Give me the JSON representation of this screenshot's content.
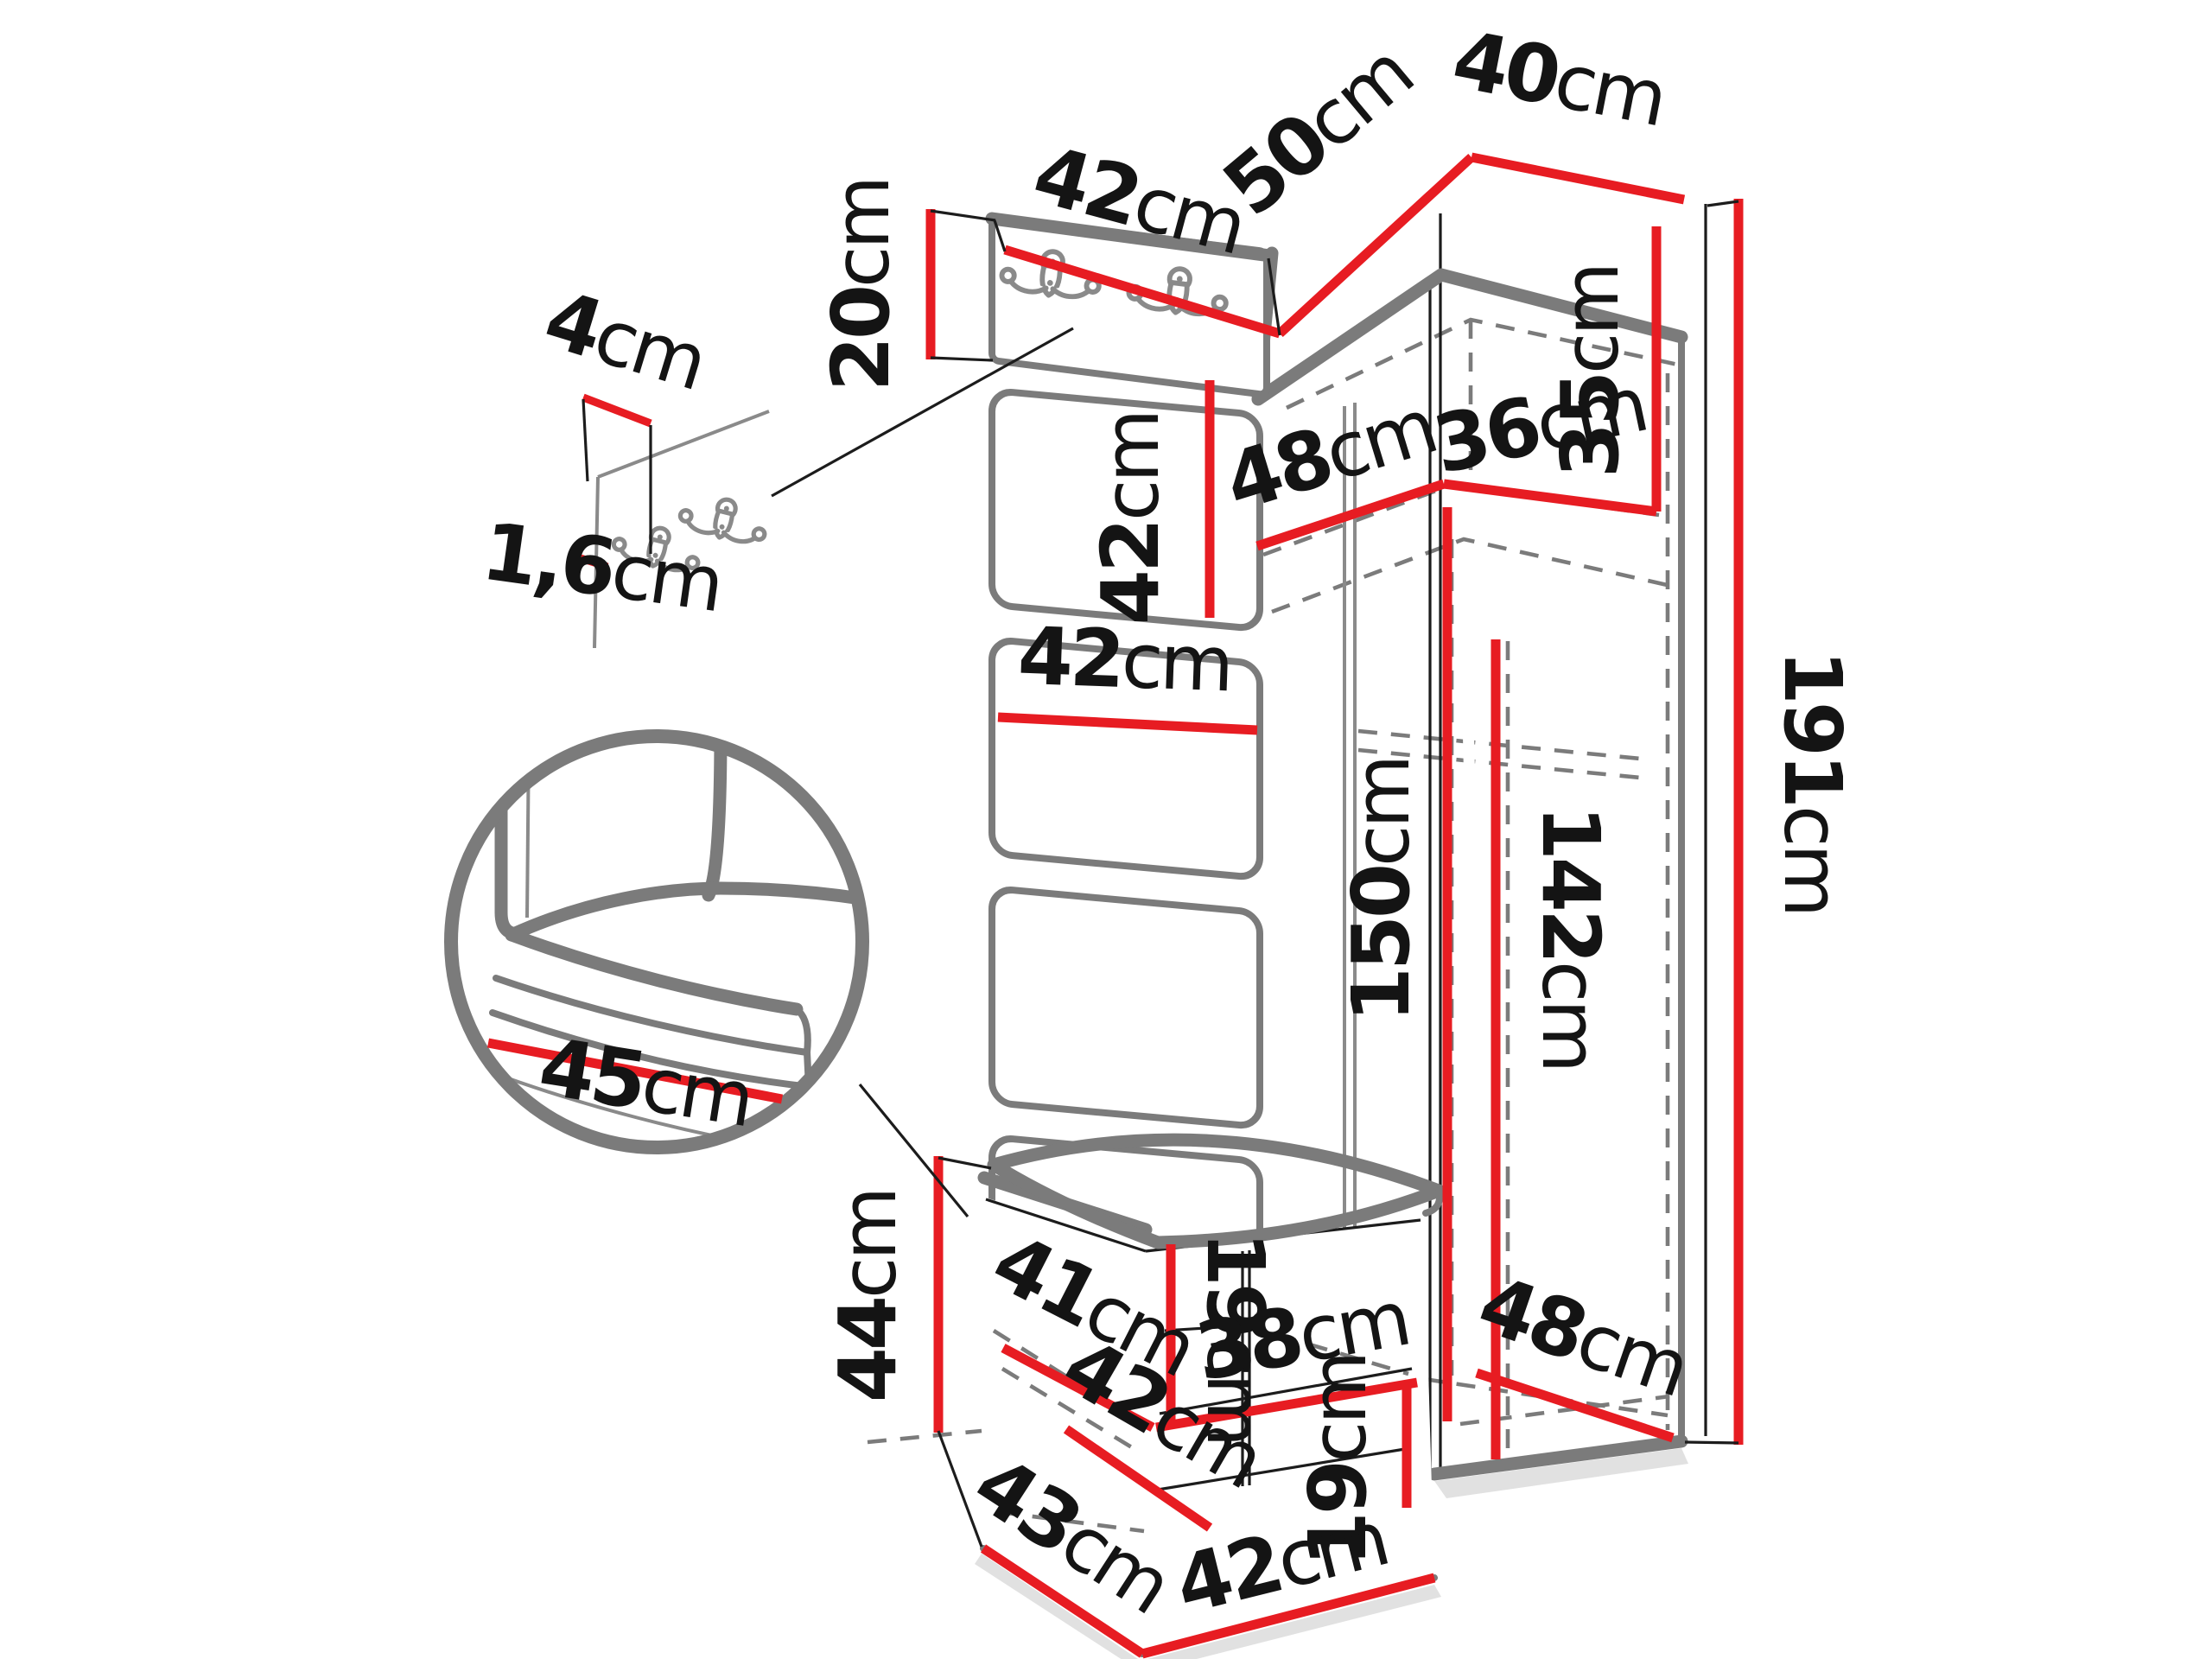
{
  "colors": {
    "dimension_red": "#e71c22",
    "outline_gray": "#7b7b7b",
    "label_black": "#141414",
    "background": "#ffffff"
  },
  "dims": {
    "top_panel_width": {
      "v": "42",
      "u": "cm"
    },
    "top_left_depth": {
      "v": "50",
      "u": "cm"
    },
    "top_right_width": {
      "v": "40",
      "u": "cm"
    },
    "hook_panel_height": {
      "v": "20",
      "u": "cm"
    },
    "upper_panel_height": {
      "v": "42",
      "u": "cm"
    },
    "top_shelf_depth": {
      "v": "48",
      "u": "cm"
    },
    "top_shelf_width": {
      "v": "36",
      "u": "cm"
    },
    "top_compartment_height": {
      "v": "35",
      "u": "cm"
    },
    "panel_width": {
      "v": "42",
      "u": "cm"
    },
    "interior_height_left": {
      "v": "150",
      "u": "cm"
    },
    "interior_height_right": {
      "v": "142",
      "u": "cm"
    },
    "total_height": {
      "v": "191",
      "u": "cm"
    },
    "bench_height": {
      "v": "44",
      "u": "cm"
    },
    "bench_inner_depth": {
      "v": "41",
      "u": "cm"
    },
    "bench_upper_compartment": {
      "v": "19",
      "u": "cm"
    },
    "bench_shelf_width": {
      "v": "38",
      "u": "cm"
    },
    "bench_lower_shelf_width": {
      "v": "42",
      "u": "cm"
    },
    "bench_lower_compartment": {
      "v": "19",
      "u": "cm"
    },
    "bench_base_depth": {
      "v": "43",
      "u": "cm"
    },
    "bench_base_width": {
      "v": "42",
      "u": "cm"
    },
    "wardrobe_floor_depth": {
      "v": "48",
      "u": "cm"
    },
    "seat_depth": {
      "v": "45",
      "u": "cm"
    },
    "mini_panel_thickness": {
      "v": "4",
      "u": "cm"
    },
    "mini_panel_board": {
      "v": "1,6",
      "u": "cm"
    }
  }
}
